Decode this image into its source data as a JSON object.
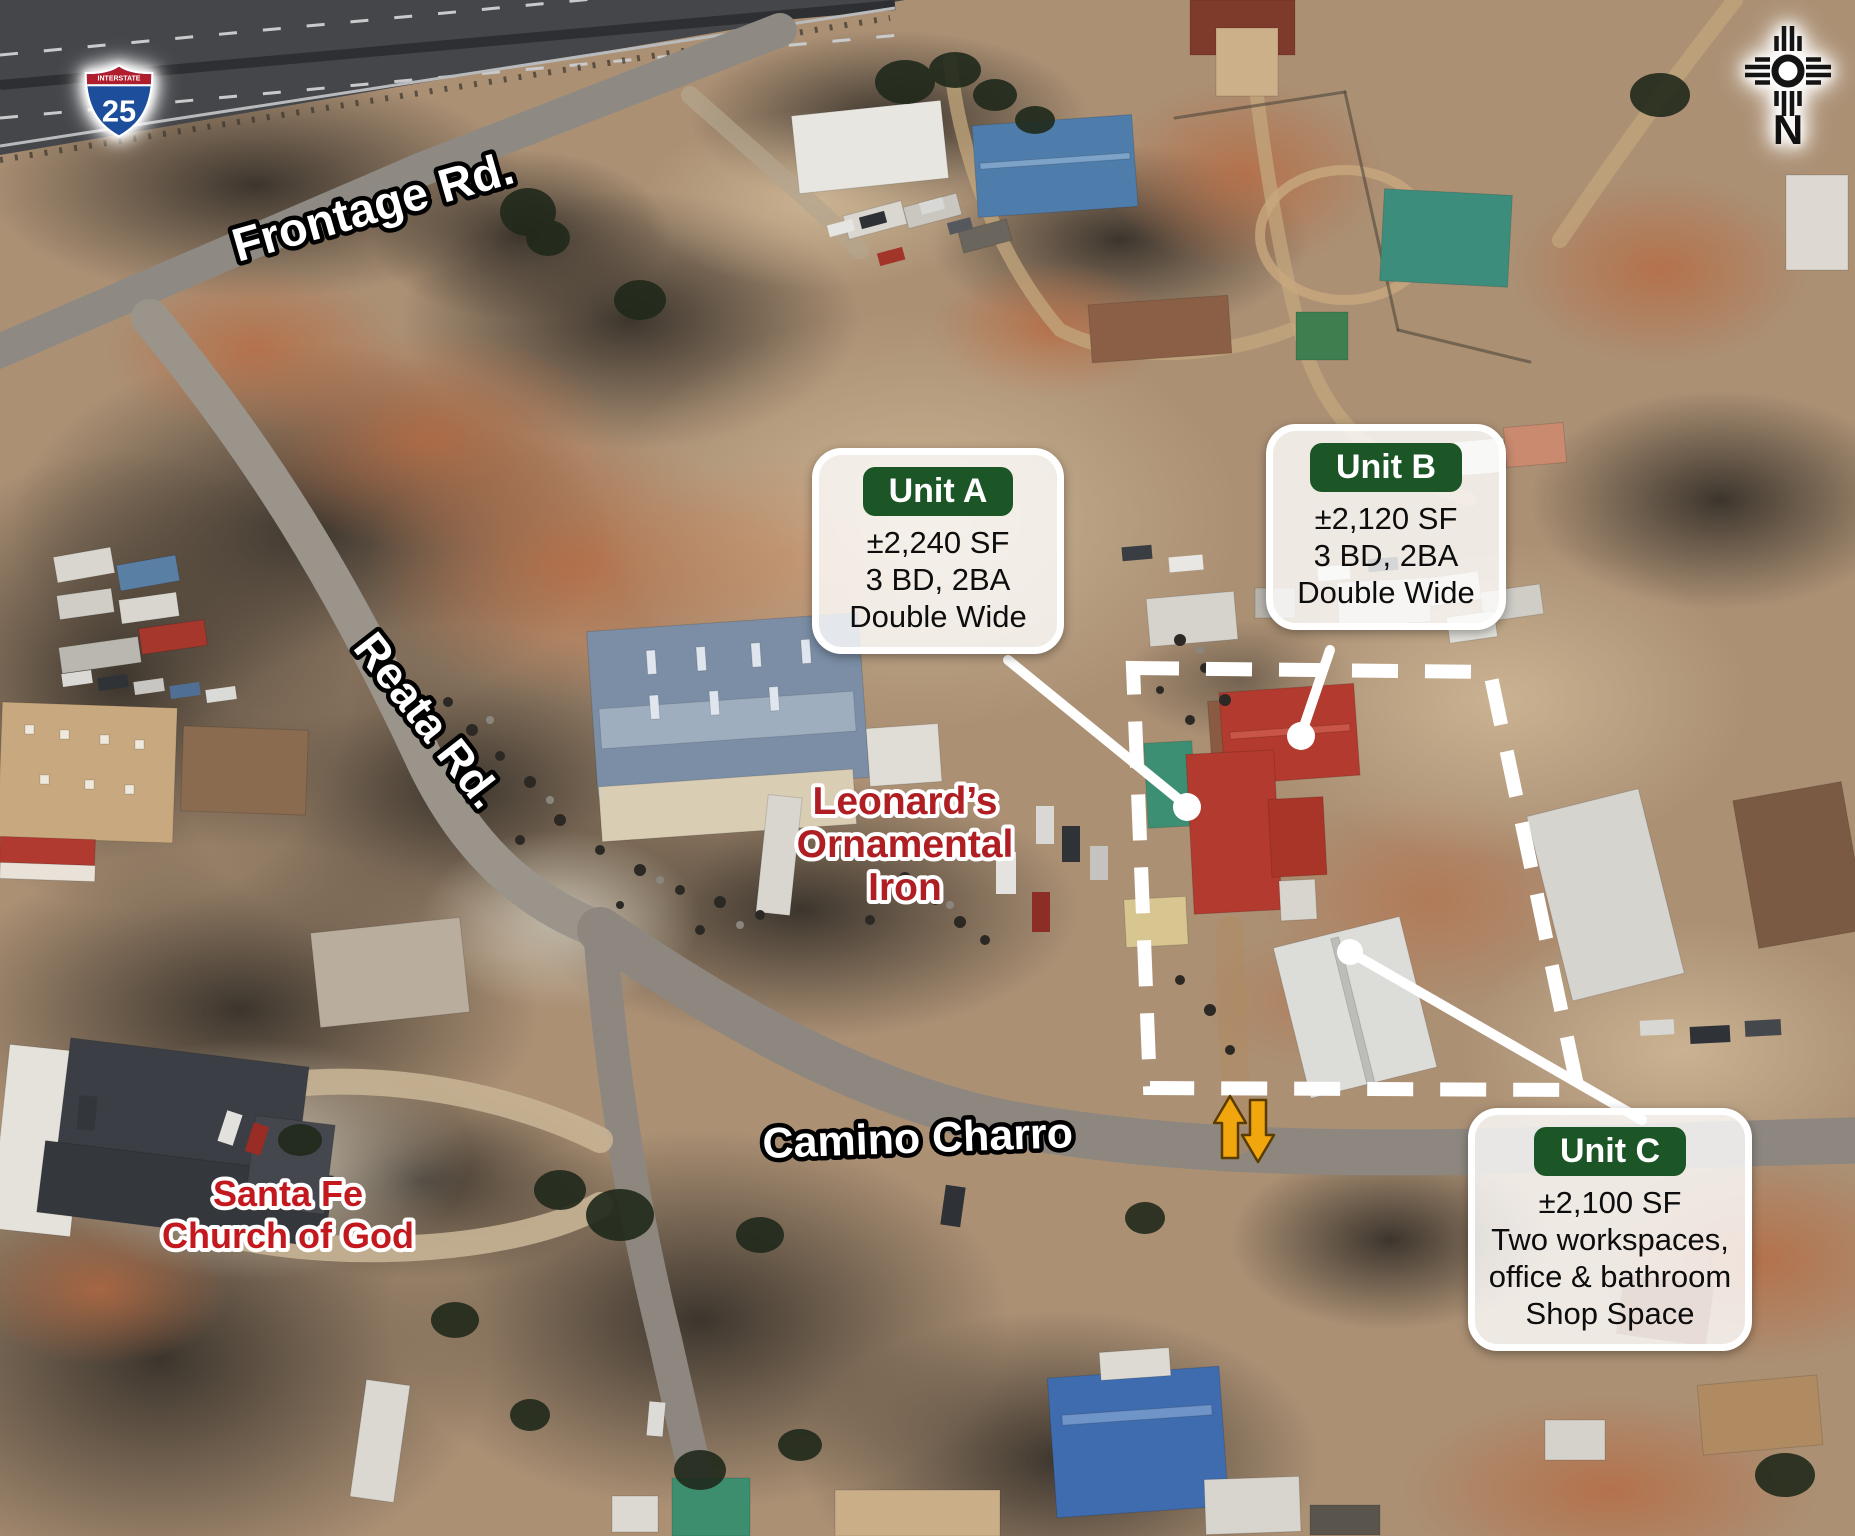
{
  "theme": {
    "callout_header_green": "#1c5627",
    "callout_bg": "rgba(255,255,255,0.8)",
    "road_label_white": "#ffffff",
    "business_label_red": "#ae1e22",
    "church_label_red": "#c2181e",
    "boundary_white": "#ffffff",
    "arrow_amber": "#f2a60d",
    "shield_red": "#b01e2e",
    "shield_blue": "#1c4e9c"
  },
  "annotations": {
    "interstate_shield": {
      "label": "INTERSTATE",
      "route_number": "25"
    },
    "compass": {
      "letter": "N",
      "icon": "zia-sun-symbol"
    },
    "road_labels": [
      {
        "id": "frontage",
        "text": "Frontage Rd."
      },
      {
        "id": "reata",
        "text": "Reata Rd."
      },
      {
        "id": "camino",
        "text": "Camino Charro"
      }
    ],
    "place_labels": [
      {
        "id": "leonards",
        "lines": [
          "Leonard’s",
          "Ornamental",
          "Iron"
        ]
      },
      {
        "id": "church",
        "lines": [
          "Santa Fe",
          "Church of God"
        ]
      }
    ],
    "callouts": [
      {
        "id": "unit-a",
        "title": "Unit A",
        "lines": [
          "±2,240 SF",
          "3 BD, 2BA",
          "Double Wide"
        ]
      },
      {
        "id": "unit-b",
        "title": "Unit B",
        "lines": [
          "±2,120 SF",
          "3 BD, 2BA",
          "Double Wide"
        ]
      },
      {
        "id": "unit-c",
        "title": "Unit C",
        "lines": [
          "±2,100 SF",
          "Two workspaces,",
          "office & bathroom",
          "Shop Space"
        ]
      }
    ]
  }
}
